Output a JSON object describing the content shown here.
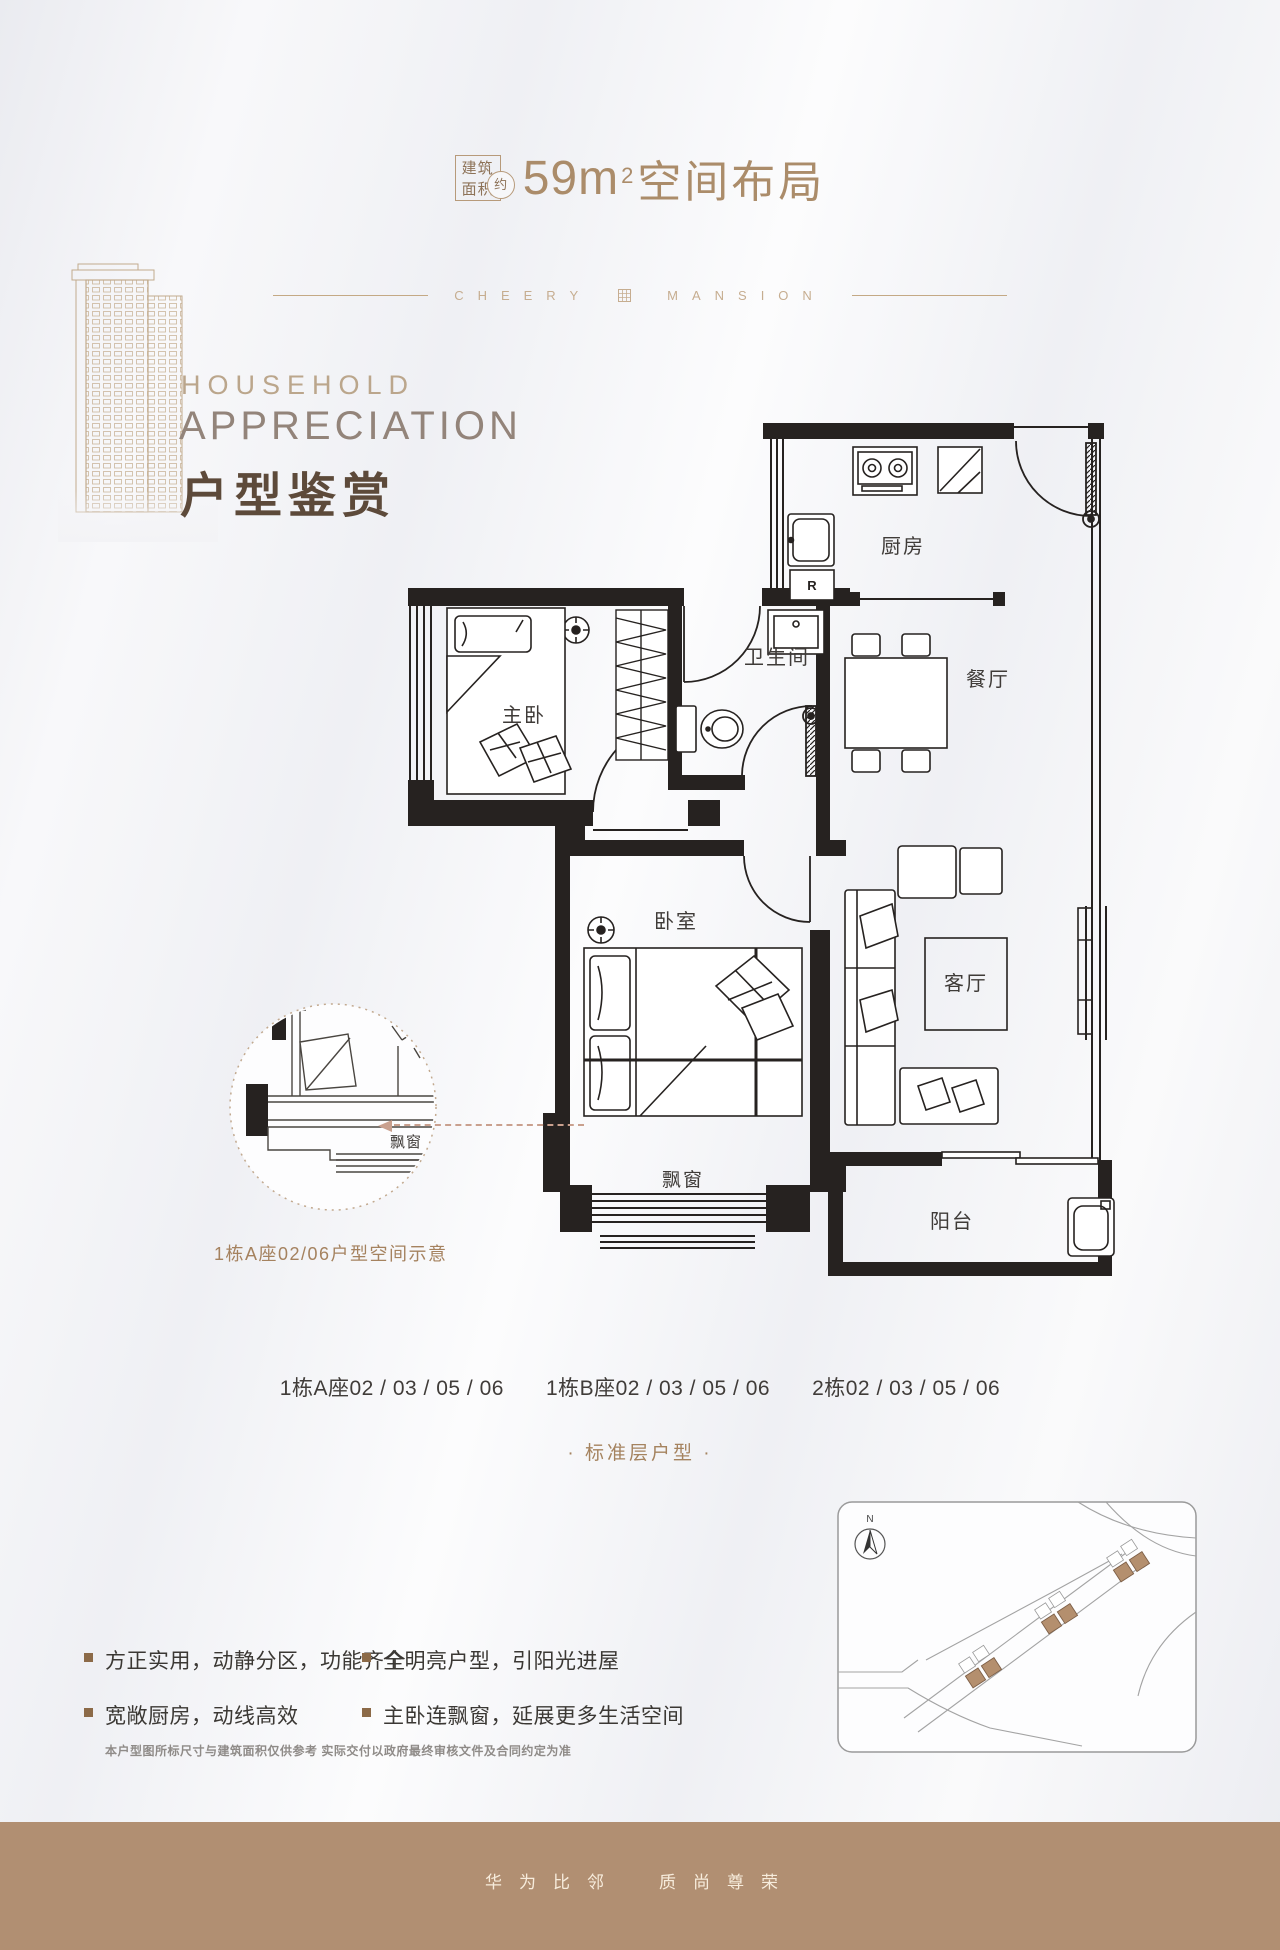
{
  "header": {
    "area_label_line1": "建筑",
    "area_label_line2": "面积",
    "approx_badge": "约",
    "area_value": "59m",
    "area_exponent": "2",
    "title_rest": "空间布局"
  },
  "brandline": {
    "left_word": "CHEERY",
    "right_word": "MANSION"
  },
  "hero": {
    "eyebrow": "HOUSEHOLD",
    "title_en": "APPRECIATION",
    "title_cn": "户型鉴赏"
  },
  "floorplan": {
    "labels": {
      "kitchen": "厨房",
      "dining": "餐厅",
      "bathroom": "卫生间",
      "master_bedroom": "主卧",
      "bedroom": "卧室",
      "living_room": "客厅",
      "bay_window": "飘窗",
      "balcony": "阳台",
      "fridge": "R"
    },
    "detail_callout": {
      "label": "飘窗",
      "caption": "1栋A座02/06户型空间示意"
    }
  },
  "units_row": {
    "groups": [
      "1栋A座02 / 03 / 05 / 06",
      "1栋B座02 / 03 / 05 / 06",
      "2栋02 / 03 / 05 / 06"
    ]
  },
  "floor_type_note": "· 标准层户型 ·",
  "site_map": {
    "north_label": "N"
  },
  "selling_points": {
    "col1": [
      "方正实用，动静分区，功能齐全",
      "宽敞厨房，动线高效"
    ],
    "col2": [
      "全明亮户型，引阳光进屋",
      "主卧连飘窗，延展更多生活空间"
    ]
  },
  "disclaimer": "本户型图所标尺寸与建筑面积仅供参考 实际交付以政府最终审核文件及合同约定为准",
  "footer": {
    "slogan_part1": "华为比邻",
    "slogan_part2": "质尚尊荣"
  },
  "colors": {
    "accent_tan": "#ab8c6a",
    "dark_brown": "#5d4a3a",
    "band": "#b18f72",
    "wall": "#262220",
    "label_gray": "#3f3b38",
    "brown_text": "#a5825f"
  }
}
